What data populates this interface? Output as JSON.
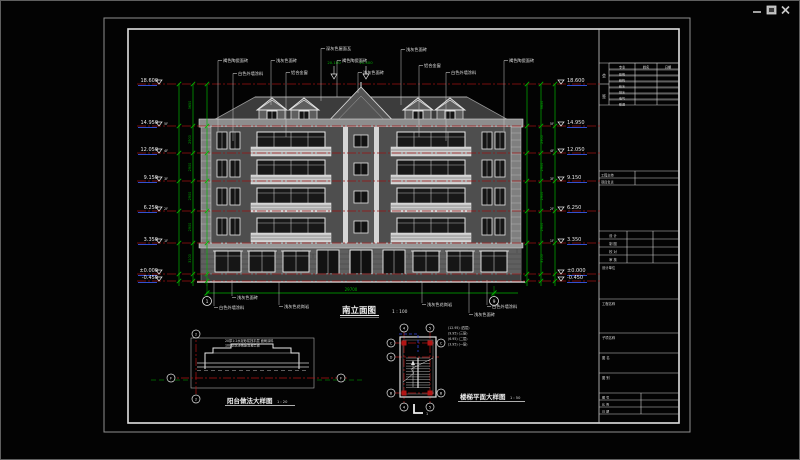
{
  "window": {
    "controls": [
      {
        "icon": "minimize-icon"
      },
      {
        "icon": "restore-icon"
      },
      {
        "icon": "close-icon"
      }
    ]
  },
  "colors": {
    "level_red": "#9a1212",
    "detail_red": "#b31414",
    "dim_green": "#00b300",
    "marker_blue": "#2f4fd0",
    "line_white": "#e8e8e8",
    "sheet_gray": "#8f8f8f"
  },
  "elevation": {
    "title": "南立面图",
    "scale": "1 : 100",
    "axis_left": "1",
    "axis_right": "9",
    "overall_dim": "29700",
    "story_dims": [
      "3650",
      "2900",
      "2900",
      "2900",
      "2900",
      "3100"
    ],
    "levels": [
      {
        "value": "18.600",
        "tag": "",
        "y": 83
      },
      {
        "value": "14.950",
        "tag": "5F",
        "y": 125
      },
      {
        "value": "12.050",
        "tag": "4F",
        "y": 152
      },
      {
        "value": "9.150",
        "tag": "3F",
        "y": 180
      },
      {
        "value": "6.250",
        "tag": "2F",
        "y": 210
      },
      {
        "value": "3.350",
        "tag": "1F",
        "y": 242
      },
      {
        "value": "±0.000",
        "tag": "",
        "y": 273
      },
      {
        "value": "-0.450",
        "tag": "",
        "y": 280
      }
    ],
    "ridge_levels": [
      {
        "value": "20.100",
        "x": 333
      },
      {
        "value": "21.400",
        "x": 365
      }
    ],
    "top_annotations": [
      {
        "text": "褐色陶瓷面砖",
        "x": 222,
        "y": 61,
        "drop": 130
      },
      {
        "text": "白色外墙涂料",
        "x": 237,
        "y": 74,
        "drop": 140
      },
      {
        "text": "浅灰色面砖",
        "x": 275,
        "y": 61,
        "drop": 104
      },
      {
        "text": "铝合金窗",
        "x": 290,
        "y": 73,
        "drop": 136
      },
      {
        "text": "深灰色屋面瓦",
        "x": 325,
        "y": 49,
        "drop": 100
      },
      {
        "text": "褐色陶瓷面砖",
        "x": 341,
        "y": 61,
        "drop": 96
      },
      {
        "text": "浅灰色面砖",
        "x": 362,
        "y": 73,
        "drop": 92
      },
      {
        "text": "浅灰色面砖",
        "x": 405,
        "y": 50,
        "drop": 104
      },
      {
        "text": "铝合金窗",
        "x": 423,
        "y": 66,
        "drop": 136
      },
      {
        "text": "白色外墙涂料",
        "x": 450,
        "y": 73,
        "drop": 140
      },
      {
        "text": "褐色陶瓷面砖",
        "x": 508,
        "y": 61,
        "drop": 130
      }
    ],
    "bottom_annotations": [
      {
        "text": "浅灰色面砖",
        "x": 236,
        "y": 298,
        "tip": 279
      },
      {
        "text": "白色外墙涂料",
        "x": 218,
        "y": 308,
        "tip": 279
      },
      {
        "text": "浅灰色花岗岩",
        "x": 283,
        "y": 307,
        "tip": 281
      },
      {
        "text": "浅灰色花岗岩",
        "x": 426,
        "y": 305,
        "tip": 281
      },
      {
        "text": "白色外墙涂料",
        "x": 491,
        "y": 307,
        "tip": 279
      },
      {
        "text": "浅灰色面砖",
        "x": 473,
        "y": 315,
        "tip": 281
      }
    ]
  },
  "balcony_detail": {
    "title": "阳台做法大样图",
    "scale": "1 : 20",
    "notes": [
      "20厚1:2水泥砂浆找平层 面刷涂料",
      "100厚现浇钢筋混凝土板"
    ],
    "axis_top": "2",
    "axis_bottom": "2",
    "axis_left": "F",
    "axis_right": "F"
  },
  "stair_detail": {
    "title": "楼梯平面大样图",
    "scale": "1 : 50",
    "legend": [
      "(12.95) (四层)",
      "(9.95) (三层)",
      "(6.95) (二层)",
      "(3.95) (一层)"
    ],
    "axes_top": [
      "4",
      "5"
    ],
    "axes_bottom": [
      "4",
      "5"
    ],
    "axes_left": [
      "C",
      "D",
      "B"
    ],
    "axes_right": [
      "C",
      "B"
    ],
    "section_mark": "1"
  },
  "title_block": {
    "sign_col": [
      "会",
      "签"
    ],
    "sign_headers": [
      "专业",
      "姓名",
      "日期"
    ],
    "sign_rows": [
      "建筑",
      "结构",
      "给水",
      "排水",
      "电气",
      "暖通"
    ],
    "mid_rows": [
      "工程主持",
      "项目负责"
    ],
    "approval_rows": [
      "设 计",
      "制 图",
      "校 对",
      "审 核"
    ],
    "boxes": [
      "设计单位",
      "工程名称",
      "子项名称",
      "图 名",
      "图 别"
    ],
    "small_rows": [
      "图 号",
      "比 例",
      "日 期"
    ]
  }
}
